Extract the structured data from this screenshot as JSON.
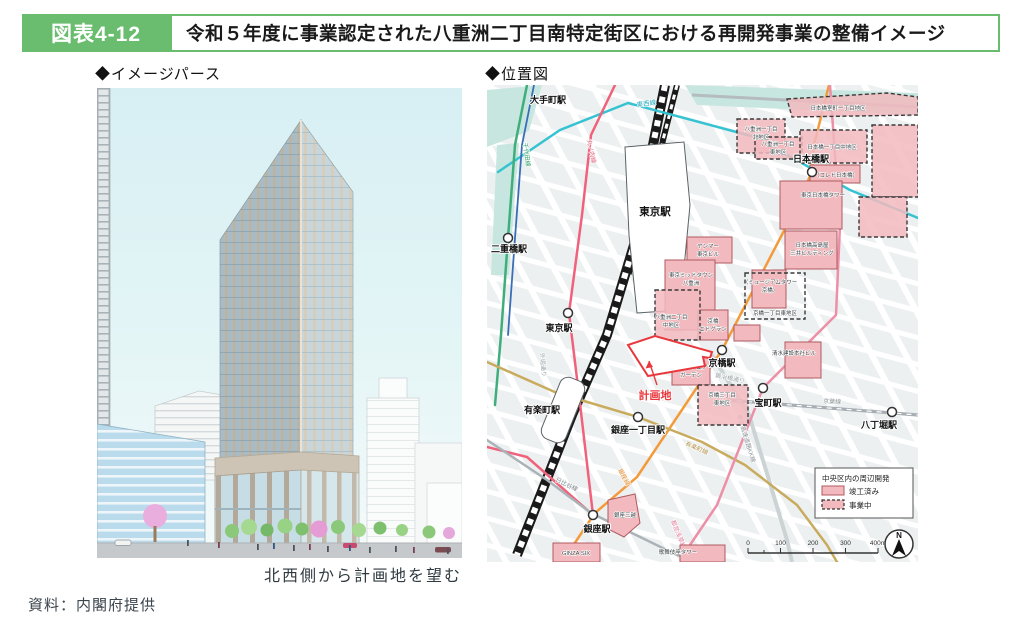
{
  "header": {
    "figure_label": "図表4-12",
    "title": "令和５年度に事業認定された八重洲二丁目南特定街区における再開発事業の整備イメージ"
  },
  "panels": {
    "left_heading": "◆イメージパース",
    "right_heading": "◆位置図",
    "left_caption": "北西側から計画地を望む"
  },
  "source": "資料：内閣府提供",
  "colors": {
    "accent_green": "#6abd6e",
    "area_pink": "#f2babe",
    "area_border_solid": "#b05a60",
    "site_red": "#e8383d",
    "water_teal": "#c8e6e0"
  },
  "map": {
    "stations": [
      {
        "label": "大手町駅"
      },
      {
        "label": "日本橋駅"
      },
      {
        "label": "二重橋駅"
      },
      {
        "label": "東京駅"
      },
      {
        "label": "東京駅"
      },
      {
        "label": "有楽町駅"
      },
      {
        "label": "銀座一丁目駅"
      },
      {
        "label": "銀座駅"
      },
      {
        "label": "京橋駅"
      },
      {
        "label": "宝町駅"
      },
      {
        "label": "八丁堀駅"
      }
    ],
    "lines": [
      {
        "name": "東西線",
        "color": "#35c3d2"
      },
      {
        "name": "丸ノ内線",
        "color": "#f0627c"
      },
      {
        "name": "千代田線",
        "color": "#3fae7c"
      },
      {
        "name": "銀座線",
        "color": "#f39a3b"
      },
      {
        "name": "日比谷線",
        "color": "#aab3b8"
      },
      {
        "name": "有楽町線",
        "color": "#c9ab5e"
      },
      {
        "name": "都営浅草線",
        "color": "#ec8fa7"
      },
      {
        "name": "京葉線",
        "color": "#a6adb3"
      }
    ],
    "streets": [
      {
        "name": "外堀通り"
      },
      {
        "name": "鍛冶橋通り"
      },
      {
        "name": "東京高速道路KK線"
      }
    ],
    "site": {
      "label": "計画地"
    },
    "areas": [
      {
        "line1": "日本橋室町一丁目地区",
        "line2": "",
        "status": "ongoing"
      },
      {
        "line1": "八重洲一丁目",
        "line2": "北地区",
        "status": "ongoing"
      },
      {
        "line1": "八重洲一丁目",
        "line2": "東地区",
        "status": "ongoing"
      },
      {
        "line1": "日本橋一丁目中地区",
        "line2": "",
        "status": "ongoing"
      },
      {
        "line1": "（コレド日本橋）",
        "line2": "",
        "status": "completed"
      },
      {
        "line1": "東京日本橋タワー",
        "line2": "",
        "status": "completed"
      },
      {
        "line1": "日本橋高島屋",
        "line2": "三井ビルディング",
        "status": "completed"
      },
      {
        "line1": "ヤンマー",
        "line2": "東京ビル",
        "status": "completed"
      },
      {
        "line1": "東京ミッドタウン",
        "line2": "八重洲",
        "status": "completed"
      },
      {
        "line1": "（ミュージアムタワー",
        "line2": "京橋）",
        "status": "completed"
      },
      {
        "line1": "京橋一丁目東地区",
        "line2": "",
        "status": "ongoing"
      },
      {
        "line1": "八重洲二丁目",
        "line2": "中地区",
        "status": "ongoing"
      },
      {
        "line1": "京橋",
        "line2": "エドグラン",
        "status": "completed"
      },
      {
        "line1": "東京スクエア",
        "line2": "ガーデン",
        "status": "completed"
      },
      {
        "line1": "清水建設本社ビル",
        "line2": "",
        "status": "completed"
      },
      {
        "line1": "京橋三丁目",
        "line2": "東地区",
        "status": "ongoing"
      },
      {
        "line1": "銀座三越",
        "line2": "",
        "status": "completed"
      },
      {
        "line1": "GINZA SIX",
        "line2": "",
        "status": "completed"
      },
      {
        "line1": "歌舞伎座タワー",
        "line2": "",
        "status": "completed"
      }
    ],
    "legend": {
      "title": "中央区内の周辺開発",
      "completed": "竣工済み",
      "ongoing": "事業中"
    },
    "scale_ticks": [
      "0",
      "100",
      "200",
      "300",
      "400m"
    ],
    "north": "N"
  }
}
